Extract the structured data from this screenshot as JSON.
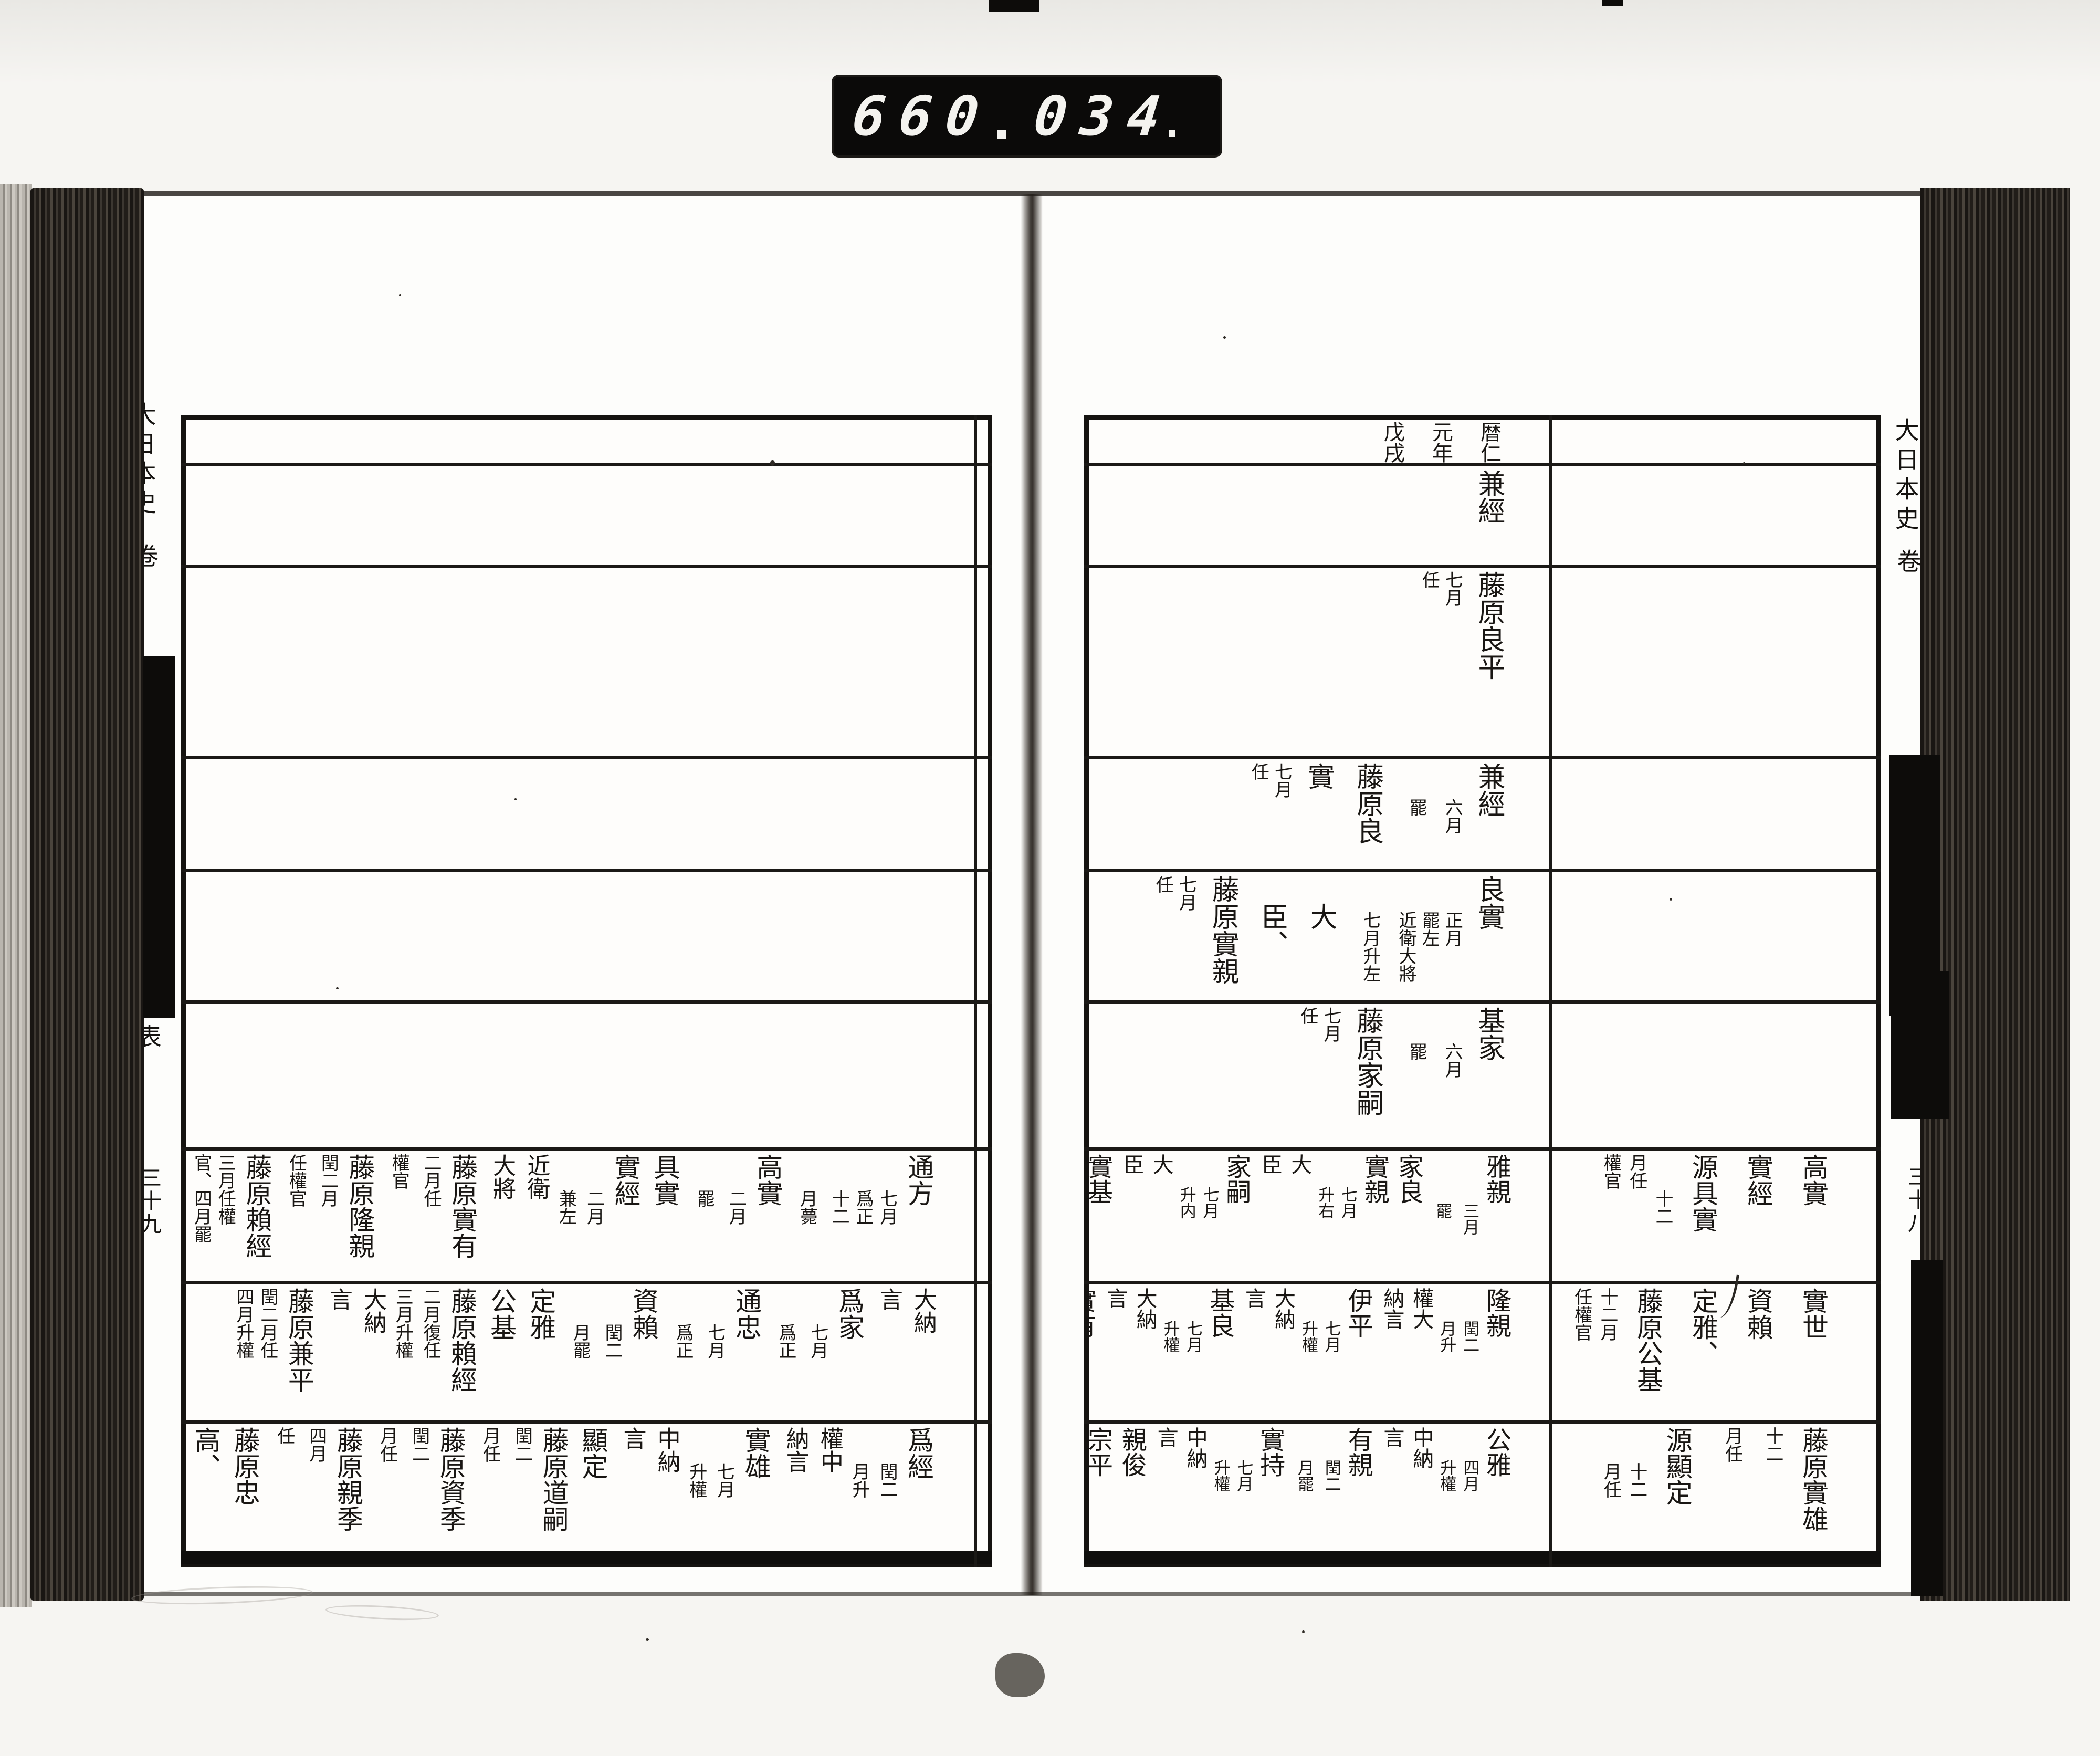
{
  "counter": {
    "left_digits": "660",
    "separator": ".",
    "right_digits": "034",
    "trailing_dot": "."
  },
  "year_header": "暦仁元年戊戌",
  "pages": {
    "right": {
      "edge": {
        "title": "大日本史",
        "volume_word": "卷",
        "section_label": "表",
        "leaf_number": "三十八"
      },
      "rows": [
        {
          "main": [
            {
              "s": "lg",
              "t": "暦仁\n元年\n戊戌"
            }
          ],
          "side": []
        },
        {
          "main": [
            {
              "s": "lg",
              "t": "兼經"
            }
          ],
          "side": []
        },
        {
          "main": [
            {
              "s": "lg",
              "t": "藤原良平"
            },
            {
              "s": "sm",
              "t": "七月\n任"
            }
          ],
          "side": []
        },
        {
          "main": [
            {
              "s": "lg",
              "t": "兼經"
            },
            {
              "s": "sm",
              "t": "　　六月\n　　罷"
            },
            {
              "s": "lg",
              "t": "藤原良實"
            },
            {
              "s": "sm",
              "t": "七月\n任"
            }
          ],
          "side": []
        },
        {
          "main": [
            {
              "s": "lg",
              "t": "良實"
            },
            {
              "s": "sm",
              "t": "　　正月\n　　罷左"
            },
            {
              "s": "sm",
              "t": "　　近衛大將\n　　七月升左"
            },
            {
              "s": "lg",
              "t": "　大\n　臣、"
            },
            {
              "s": "lg",
              "t": "藤原實親"
            },
            {
              "s": "sm",
              "t": "七月\n任"
            }
          ],
          "side": []
        },
        {
          "main": [
            {
              "s": "lg",
              "t": "基家"
            },
            {
              "s": "sm",
              "t": "　　六月\n　　罷"
            },
            {
              "s": "lg",
              "t": "藤原家嗣"
            },
            {
              "s": "sm",
              "t": "七月\n任"
            }
          ],
          "side": []
        },
        {
          "main": [
            {
              "s": "lg",
              "t": "雅親"
            },
            {
              "s": "sm",
              "t": "　　　三月\n　　　罷"
            },
            {
              "s": "lg",
              "t": "家良"
            },
            {
              "s": "lg",
              "t": "實親"
            },
            {
              "s": "sm",
              "t": "　　七月\n　　升右"
            },
            {
              "s": "md",
              "t": "大\n臣"
            },
            {
              "s": "lg",
              "t": "家嗣"
            },
            {
              "s": "sm",
              "t": "　　七月\n　　升内"
            },
            {
              "s": "md",
              "t": "大\n臣"
            },
            {
              "s": "lg",
              "t": "實基"
            }
          ],
          "side": [
            {
              "s": "lg",
              "t": "高實"
            },
            {
              "s": "lg",
              "t": "實經"
            },
            {
              "s": "lg",
              "t": "源具實"
            },
            {
              "s": "sm",
              "t": "　　十二\n月任\n權官"
            }
          ]
        },
        {
          "main": [
            {
              "s": "lg",
              "t": "隆親"
            },
            {
              "s": "sm",
              "t": "　　閏二\n　　月升"
            },
            {
              "s": "md",
              "t": "權大\n納言"
            },
            {
              "s": "lg",
              "t": "伊平"
            },
            {
              "s": "sm",
              "t": "　　七月\n　　升權"
            },
            {
              "s": "md",
              "t": "大納\n言"
            },
            {
              "s": "lg",
              "t": "基良"
            },
            {
              "s": "sm",
              "t": "　　七月\n　　升權"
            },
            {
              "s": "md",
              "t": "大納\n言"
            },
            {
              "s": "lg",
              "t": "實有"
            },
            {
              "s": "sm",
              "t": "　　二月\n　　升權"
            }
          ],
          "side": [
            {
              "s": "lg",
              "t": "實世"
            },
            {
              "s": "lg",
              "t": "資賴"
            },
            {
              "s": "lg",
              "t": "定雅、"
            },
            {
              "s": "lg",
              "t": "藤原公基"
            },
            {
              "s": "sm",
              "t": "十二月\n任權官"
            }
          ]
        },
        {
          "main": [
            {
              "s": "lg",
              "t": "公雅"
            },
            {
              "s": "sm",
              "t": "　　四月\n　　升權"
            },
            {
              "s": "md",
              "t": "中納\n言"
            },
            {
              "s": "lg",
              "t": "有親"
            },
            {
              "s": "sm",
              "t": "　　閏二\n　　月罷"
            },
            {
              "s": "lg",
              "t": "實持"
            },
            {
              "s": "sm",
              "t": "　　七月\n　　升權"
            },
            {
              "s": "md",
              "t": "中納\n言"
            },
            {
              "s": "lg",
              "t": "親俊"
            },
            {
              "s": "lg",
              "t": "宗平"
            },
            {
              "s": "sm",
              "t": "　　四月\n　　罷"
            }
          ],
          "side": [
            {
              "s": "lg",
              "t": "藤原實雄"
            },
            {
              "s": "sm",
              "t": "十二\n月任"
            },
            {
              "s": "lg",
              "t": "源顯定"
            },
            {
              "s": "sm",
              "t": "　　十二\n　　月任"
            }
          ]
        }
      ]
    },
    "left": {
      "edge": {
        "title": "大日本史",
        "volume_word": "卷",
        "section_label": "表",
        "leaf_number": "三十九"
      },
      "rows": [
        {
          "main": [],
          "side": []
        },
        {
          "main": [],
          "side": []
        },
        {
          "main": [],
          "side": []
        },
        {
          "main": [],
          "side": []
        },
        {
          "main": [],
          "side": []
        },
        {
          "main": [],
          "side": []
        },
        {
          "main": [
            {
              "s": "lg",
              "t": "通方"
            },
            {
              "s": "sm",
              "t": "　　七月\n　　爲正"
            },
            {
              "s": "sm",
              "t": "　　十二\n　　月薨"
            },
            {
              "s": "lg",
              "t": "高實"
            },
            {
              "s": "sm",
              "t": "　　二月\n　　罷"
            },
            {
              "s": "lg",
              "t": "具實"
            },
            {
              "s": "lg",
              "t": "實經"
            },
            {
              "s": "sm",
              "t": "　　二月\n　　兼左"
            },
            {
              "s": "md",
              "t": "近衛\n大將"
            },
            {
              "s": "lg",
              "t": "藤原實有"
            },
            {
              "s": "sm",
              "t": "二月任\n權官"
            },
            {
              "s": "lg",
              "t": "藤原隆親"
            },
            {
              "s": "sm",
              "t": "閏二月\n任權官"
            },
            {
              "s": "lg",
              "t": "藤原賴經"
            },
            {
              "s": "sm",
              "t": "三月任權\n官、四月罷"
            }
          ],
          "side": []
        },
        {
          "main": [
            {
              "s": "md",
              "t": "大納\n言"
            },
            {
              "s": "lg",
              "t": "爲家"
            },
            {
              "s": "sm",
              "t": "　　七月\n　　爲正"
            },
            {
              "s": "lg",
              "t": "通忠"
            },
            {
              "s": "sm",
              "t": "　　七月\n　　爲正"
            },
            {
              "s": "lg",
              "t": "資賴"
            },
            {
              "s": "sm",
              "t": "　　閏二\n　　月罷"
            },
            {
              "s": "lg",
              "t": "定雅"
            },
            {
              "s": "lg",
              "t": "公基"
            },
            {
              "s": "lg",
              "t": "藤原賴經"
            },
            {
              "s": "sm",
              "t": "二月復任\n三月升權"
            },
            {
              "s": "md",
              "t": "大納\n言"
            },
            {
              "s": "lg",
              "t": "藤原兼平"
            },
            {
              "s": "sm",
              "t": "閏二月任\n四月升權"
            }
          ],
          "side": []
        },
        {
          "main": [
            {
              "s": "lg",
              "t": "爲經"
            },
            {
              "s": "sm",
              "t": "　　閏二\n　　月升"
            },
            {
              "s": "md",
              "t": "權中\n納言"
            },
            {
              "s": "lg",
              "t": "實雄"
            },
            {
              "s": "sm",
              "t": "　　七月\n　　升權"
            },
            {
              "s": "md",
              "t": "中納\n言"
            },
            {
              "s": "lg",
              "t": "顯定"
            },
            {
              "s": "lg",
              "t": "藤原道嗣"
            },
            {
              "s": "sm",
              "t": "閏二\n月任"
            },
            {
              "s": "lg",
              "t": "藤原資季"
            },
            {
              "s": "sm",
              "t": "閏二\n月任"
            },
            {
              "s": "lg",
              "t": "藤原親季"
            },
            {
              "s": "sm",
              "t": "四月\n任"
            },
            {
              "s": "lg",
              "t": "藤原忠高、"
            }
          ],
          "side": []
        }
      ]
    }
  }
}
